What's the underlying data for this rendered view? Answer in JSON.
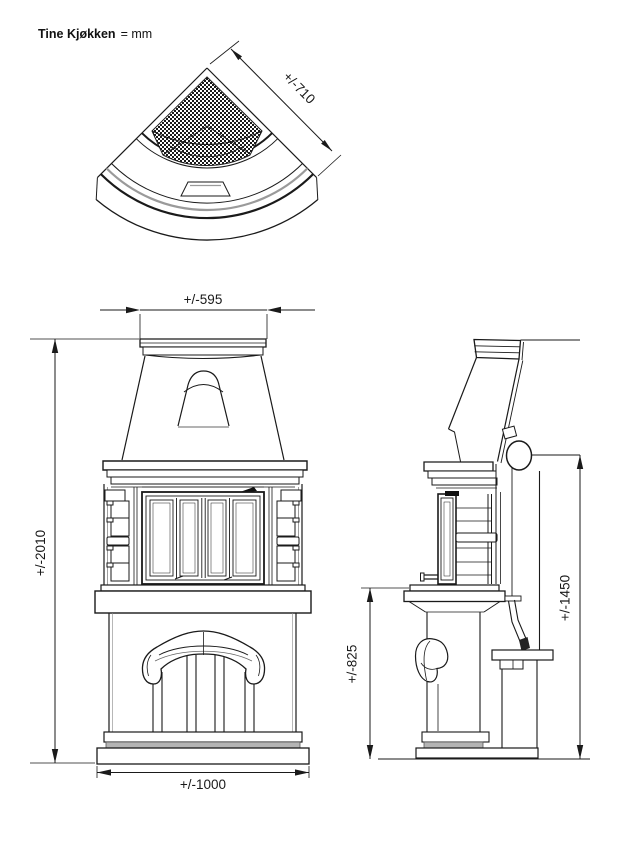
{
  "title": {
    "product": "Tine Kjøkken",
    "unit_note": "= mm"
  },
  "colors": {
    "line": "#1a1a1a",
    "gray_line": "#9a9a9a",
    "shade_gray": "#b4b4b4",
    "background": "#ffffff"
  },
  "views": {
    "plan_top": {
      "dim_depth_label": "+/-710"
    },
    "front": {
      "dim_top_width_label": "+/-595",
      "dim_total_height_label": "+/-2010",
      "dim_base_width_label": "+/-1000"
    },
    "side": {
      "dim_flue_center_height_label": "+/-1450",
      "dim_hearth_height_label": "+/-825"
    }
  }
}
